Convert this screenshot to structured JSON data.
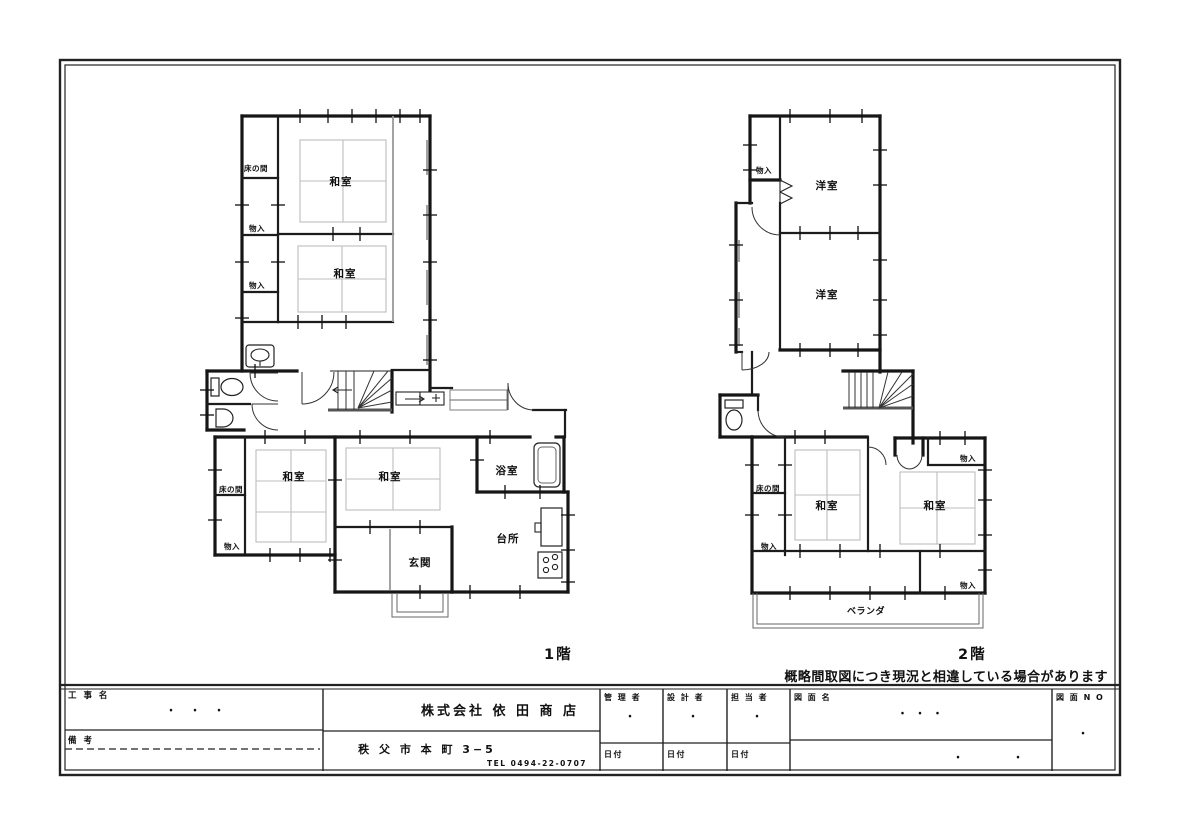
{
  "sheet": {
    "disclaimer": "概略間取図につき現況と相違している場合があります"
  },
  "floor1": {
    "caption": "1階",
    "rooms": {
      "tokonoma_upper": "床の間",
      "monoire_upper1": "物入",
      "monoire_upper2": "物入",
      "washitsu_upper1": "和室",
      "washitsu_upper2": "和室",
      "tokonoma_lower": "床の間",
      "monoire_lower": "物入",
      "washitsu_lower1": "和室",
      "washitsu_lower2": "和室",
      "genkan": "玄関",
      "yokushitsu": "浴室",
      "daidokoro": "台所"
    }
  },
  "floor2": {
    "caption": "2階",
    "rooms": {
      "monoire_top": "物入",
      "yoshitsu1": "洋室",
      "yoshitsu2": "洋室",
      "tokonoma": "床の間",
      "monoire_left": "物入",
      "washitsu1": "和室",
      "washitsu2": "和室",
      "monoire_right_top": "物入",
      "monoire_right_bottom": "物入",
      "veranda": "ベランダ"
    }
  },
  "titleblock": {
    "koujimei_label": "工 事 名",
    "koujimei_value": "・　・　・",
    "bikou_label": "備 考",
    "company": "株式会社 依 田 商 店",
    "address": "秩 父 市 本 町 3−5",
    "tel": "TEL 0494-22-0707",
    "kanrisha_label": "管 理 者",
    "kanrisha_value": "・",
    "sekkeisha_label": "設 計 者",
    "sekkeisha_value": "・",
    "tantousha_label": "担 当 者",
    "tantousha_value": "・",
    "hizuke_label1": "日付",
    "hizuke_label2": "日付",
    "hizuke_label3": "日付",
    "zumenmei_label": "図 面 名",
    "zumenmei_value1": "・ ・ ・",
    "zumenmei_value2": "・　　　　・",
    "zumen_no_label": "図 面 N O",
    "zumen_no_value": "・"
  }
}
